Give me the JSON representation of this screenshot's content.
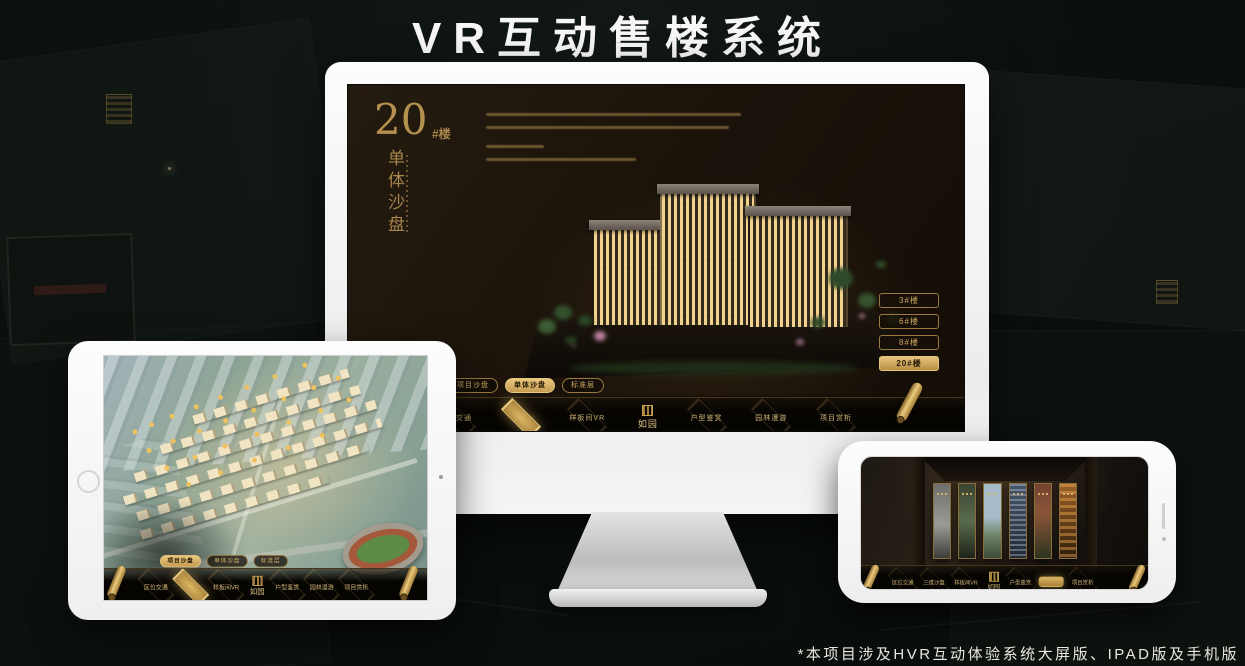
{
  "title": "VR互动售楼系统",
  "footnote": "*本项目涉及HVR互动体验系统大屏版、IPAD版及手机版",
  "colors": {
    "accent_gold": "#c8a159",
    "accent_gold_bright": "#e8c87e",
    "screen_dark": "#1b130a",
    "page_background": "#0b100d",
    "title_white": "#f7f7f7"
  },
  "nav": {
    "tabs": [
      "项目沙盘",
      "单体沙盘",
      "标准层"
    ],
    "menu": [
      "区位交通",
      "三维沙盘",
      "样板间VR",
      "如园",
      "户型鉴赏",
      "园林漫游",
      "项目赏析"
    ]
  },
  "monitor_screen": {
    "building_number": "20",
    "building_number_suffix": "#楼",
    "section_title_vertical": "单体沙盘",
    "floor_buttons": [
      "3#楼",
      "6#楼",
      "8#楼",
      "20#楼"
    ],
    "active_floor_button": "20#楼",
    "active_tab": "单体沙盘",
    "active_menu_item": "三维沙盘"
  },
  "tablet_screen": {
    "active_tab": "项目沙盘",
    "active_menu_item": "三维沙盘"
  },
  "phone_screen": {
    "active_menu_item": "园林漫游"
  }
}
